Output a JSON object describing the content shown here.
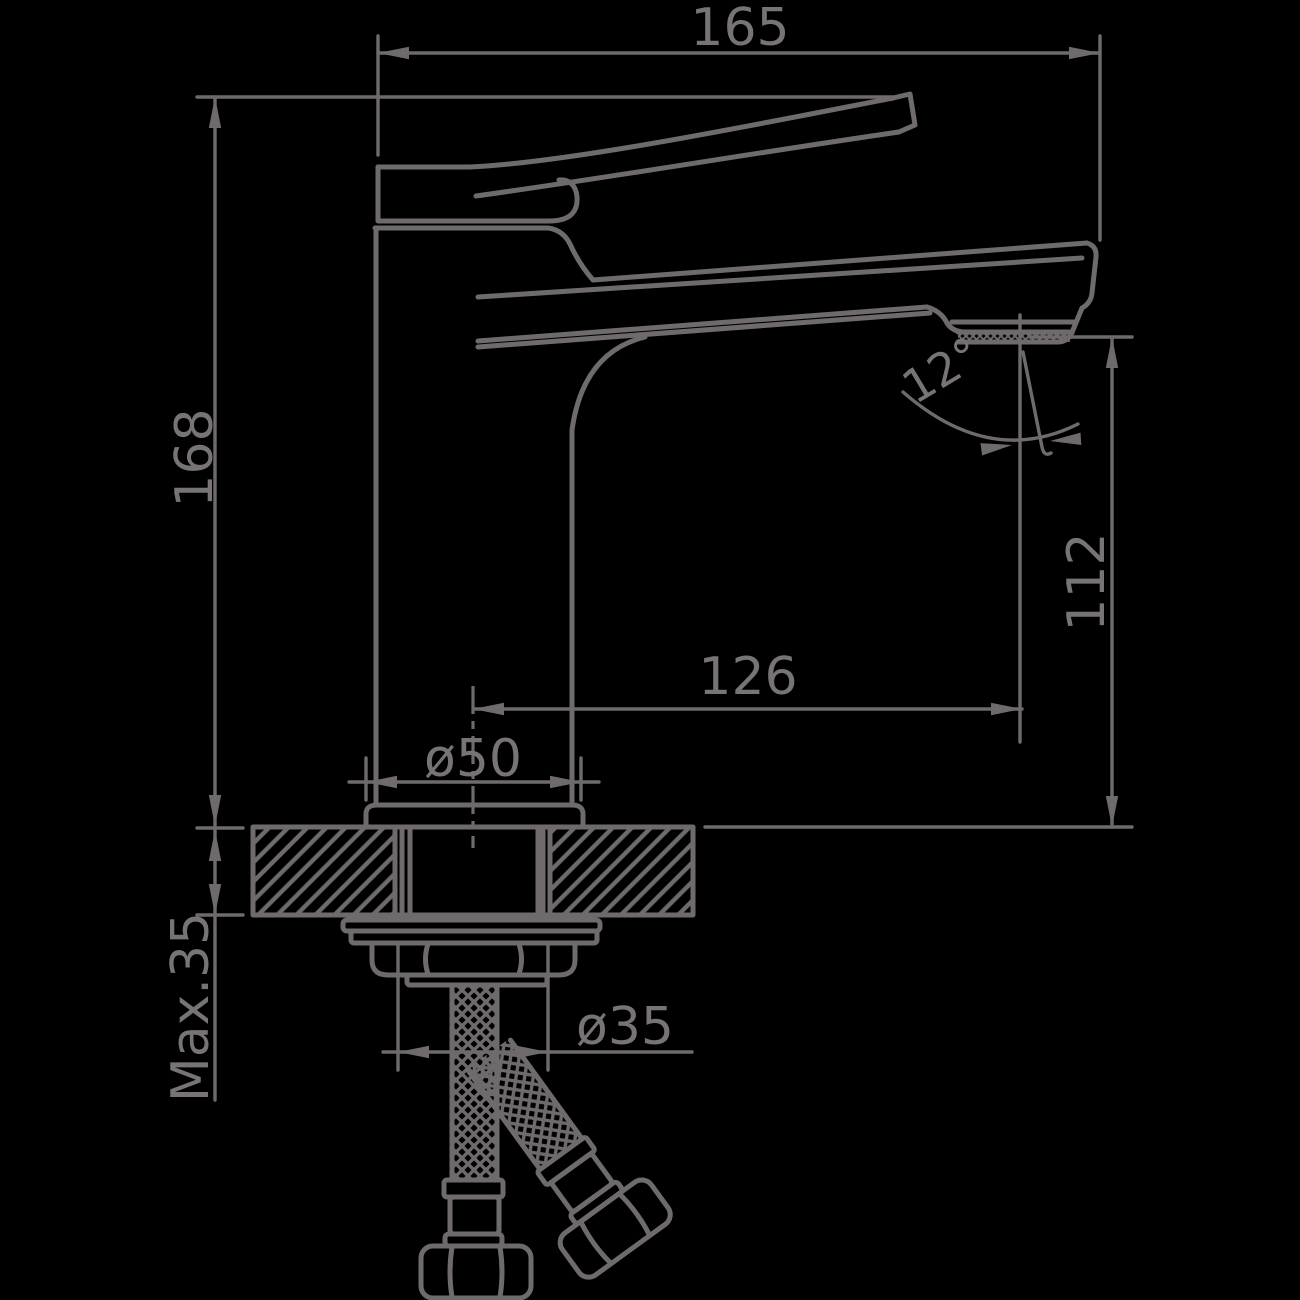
{
  "drawing": {
    "description": "faucet-technical-dimension-drawing",
    "dims": {
      "overall_length": "165",
      "overall_height": "168",
      "outlet_height": "112",
      "spout_reach": "126",
      "body_diameter": "ø50",
      "max_mounting_thickness": "Max.35",
      "connection_diameter": "ø35",
      "outlet_angle": "12°"
    },
    "colors": {
      "background": "#000000",
      "line": "#6f6b6c"
    }
  }
}
